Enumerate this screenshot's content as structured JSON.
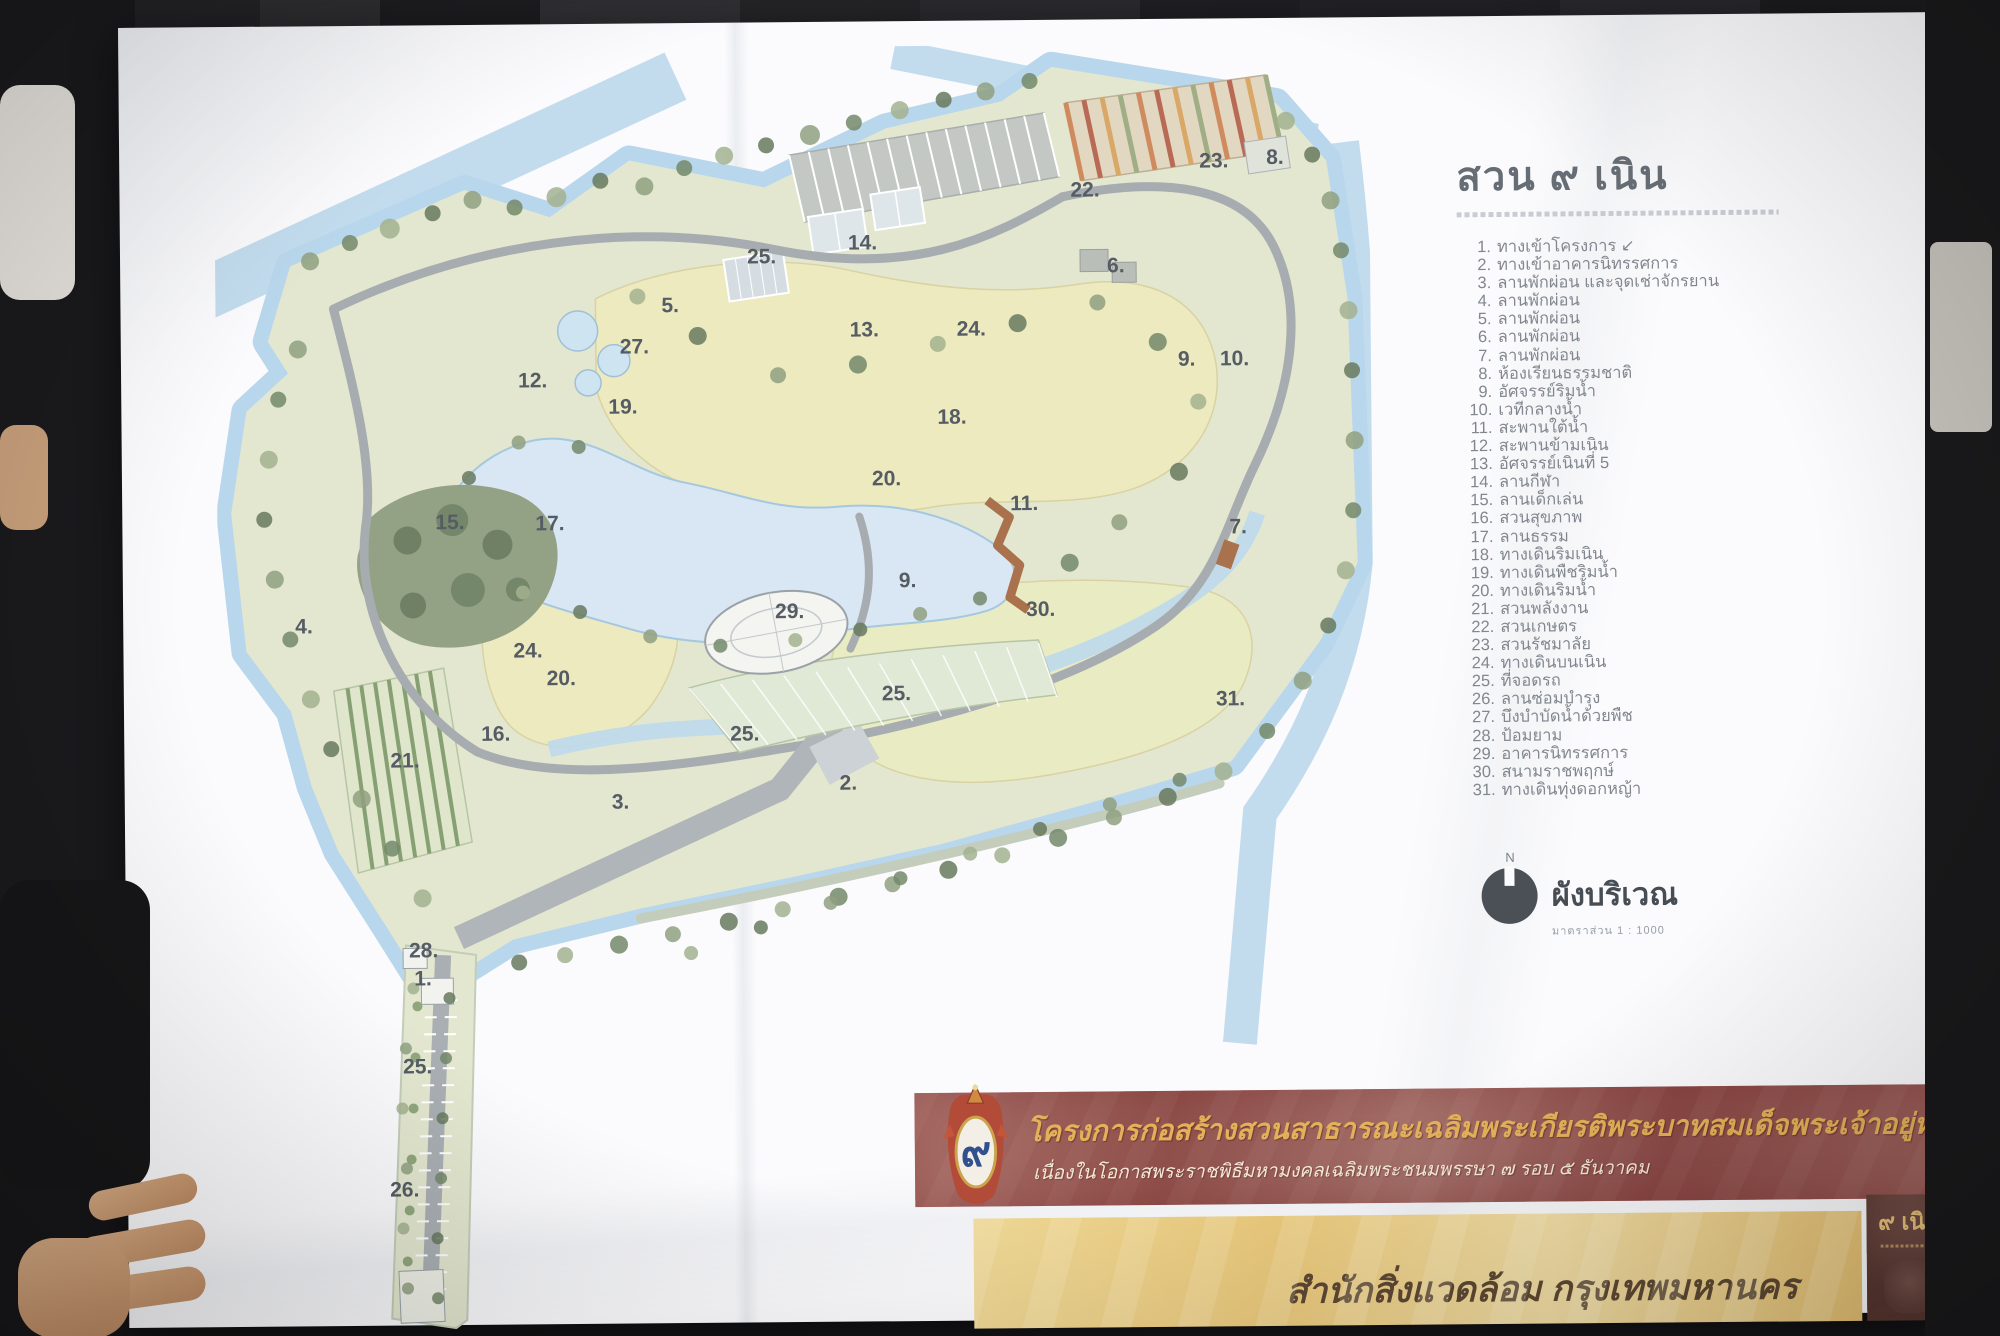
{
  "poster": {
    "title": "สวน ๙ เนิน",
    "legend": {
      "items": [
        {
          "no": "1.",
          "label": "ทางเข้าโครงการ ↙"
        },
        {
          "no": "2.",
          "label": "ทางเข้าอาคารนิทรรศการ"
        },
        {
          "no": "3.",
          "label": "ลานพักผ่อน และจุดเช่าจักรยาน"
        },
        {
          "no": "4.",
          "label": "ลานพักผ่อน"
        },
        {
          "no": "5.",
          "label": "ลานพักผ่อน"
        },
        {
          "no": "6.",
          "label": "ลานพักผ่อน"
        },
        {
          "no": "7.",
          "label": "ลานพักผ่อน"
        },
        {
          "no": "8.",
          "label": "ห้องเรียนธรรมชาติ"
        },
        {
          "no": "9.",
          "label": "อัศจรรย์ริมน้ำ"
        },
        {
          "no": "10.",
          "label": "เวทีกลางน้ำ"
        },
        {
          "no": "11.",
          "label": "สะพานใต้น้ำ"
        },
        {
          "no": "12.",
          "label": "สะพานข้ามเนิน"
        },
        {
          "no": "13.",
          "label": "อัศจรรย์เนินที่ 5"
        },
        {
          "no": "14.",
          "label": "ลานกีฬา"
        },
        {
          "no": "15.",
          "label": "ลานเด็กเล่น"
        },
        {
          "no": "16.",
          "label": "สวนสุขภาพ"
        },
        {
          "no": "17.",
          "label": "ลานธรรม"
        },
        {
          "no": "18.",
          "label": "ทางเดินริมเนิน"
        },
        {
          "no": "19.",
          "label": "ทางเดินพืชริมน้ำ"
        },
        {
          "no": "20.",
          "label": "ทางเดินริมน้ำ"
        },
        {
          "no": "21.",
          "label": "สวนพลังงาน"
        },
        {
          "no": "22.",
          "label": "สวนเกษตร"
        },
        {
          "no": "23.",
          "label": "สวนรัชมาลัย"
        },
        {
          "no": "24.",
          "label": "ทางเดินบนเนิน"
        },
        {
          "no": "25.",
          "label": "ที่จอดรถ"
        },
        {
          "no": "26.",
          "label": "ลานซ่อมบำรุง"
        },
        {
          "no": "27.",
          "label": "บึงบำบัดน้ำด้วยพืช"
        },
        {
          "no": "28.",
          "label": "ป้อมยาม"
        },
        {
          "no": "29.",
          "label": "อาคารนิทรรศการ"
        },
        {
          "no": "30.",
          "label": "สนามราชพฤกษ์"
        },
        {
          "no": "31.",
          "label": "ทางเดินทุ่งดอกหญ้า"
        }
      ]
    },
    "north_arrow": {
      "letter": "N",
      "label": "ผังบริเวณ",
      "scale": "มาตราส่วน 1 : 1000"
    },
    "banner": {
      "line1": "โครงการก่อสร้างสวนสาธารณะเฉลิมพระเกียรติพระบาทสมเด็จพระเจ้าอยู่หัว",
      "line2": "เนื่องในโอกาสพระราชพิธีมหามงคลเฉลิมพระชนมพรรษา ๗ รอบ ๕ ธันวาคม"
    },
    "footer": {
      "agency": "สำนักสิ่งแวดล้อม กรุงเทพมหานคร"
    },
    "badge": {
      "label": "๙ เนิน"
    },
    "colors": {
      "banner_red": "#96534e",
      "banner_gold": "#e3b159",
      "footer_yellow": "#e9c87b",
      "badge_brown": "#6f4b44",
      "water": "#c2dcee",
      "lake": "#d8e7f3",
      "lawn": "#edeabf",
      "park_green": "#e3e7cf",
      "path_gray": "#a7acb1",
      "legend_ink": "#82878f"
    }
  },
  "map": {
    "markers": [
      {
        "label": "1.",
        "x": 193,
        "y": 935
      },
      {
        "label": "2.",
        "x": 620,
        "y": 743
      },
      {
        "label": "3.",
        "x": 392,
        "y": 760
      },
      {
        "label": "4.",
        "x": 77,
        "y": 582
      },
      {
        "label": "5.",
        "x": 446,
        "y": 264
      },
      {
        "label": "6.",
        "x": 892,
        "y": 228
      },
      {
        "label": "7.",
        "x": 1012,
        "y": 490
      },
      {
        "label": "8.",
        "x": 1052,
        "y": 121
      },
      {
        "label": "9.",
        "x": 962,
        "y": 322
      },
      {
        "label": "10.",
        "x": 1004,
        "y": 322
      },
      {
        "label": "9.",
        "x": 681,
        "y": 541
      },
      {
        "label": "11.",
        "x": 793,
        "y": 465
      },
      {
        "label": "12.",
        "x": 302,
        "y": 338
      },
      {
        "label": "13.",
        "x": 634,
        "y": 290
      },
      {
        "label": "14.",
        "x": 633,
        "y": 203
      },
      {
        "label": "15.",
        "x": 218,
        "y": 479
      },
      {
        "label": "16.",
        "x": 262,
        "y": 691
      },
      {
        "label": "17.",
        "x": 318,
        "y": 481
      },
      {
        "label": "18.",
        "x": 721,
        "y": 378
      },
      {
        "label": "19.",
        "x": 392,
        "y": 365
      },
      {
        "label": "20.",
        "x": 655,
        "y": 439
      },
      {
        "label": "20.",
        "x": 328,
        "y": 636
      },
      {
        "label": "21.",
        "x": 171,
        "y": 717
      },
      {
        "label": "22.",
        "x": 856,
        "y": 152
      },
      {
        "label": "23.",
        "x": 985,
        "y": 124
      },
      {
        "label": "24.",
        "x": 741,
        "y": 290
      },
      {
        "label": "24.",
        "x": 295,
        "y": 608
      },
      {
        "label": "25.",
        "x": 532,
        "y": 216
      },
      {
        "label": "25.",
        "x": 663,
        "y": 654
      },
      {
        "label": "25.",
        "x": 511,
        "y": 693
      },
      {
        "label": "25.",
        "x": 181,
        "y": 1023
      },
      {
        "label": "26.",
        "x": 167,
        "y": 1146
      },
      {
        "label": "27.",
        "x": 404,
        "y": 305
      },
      {
        "label": "28.",
        "x": 188,
        "y": 907
      },
      {
        "label": "29.",
        "x": 557,
        "y": 571
      },
      {
        "label": "30.",
        "x": 808,
        "y": 571
      },
      {
        "label": "31.",
        "x": 997,
        "y": 662
      }
    ]
  }
}
